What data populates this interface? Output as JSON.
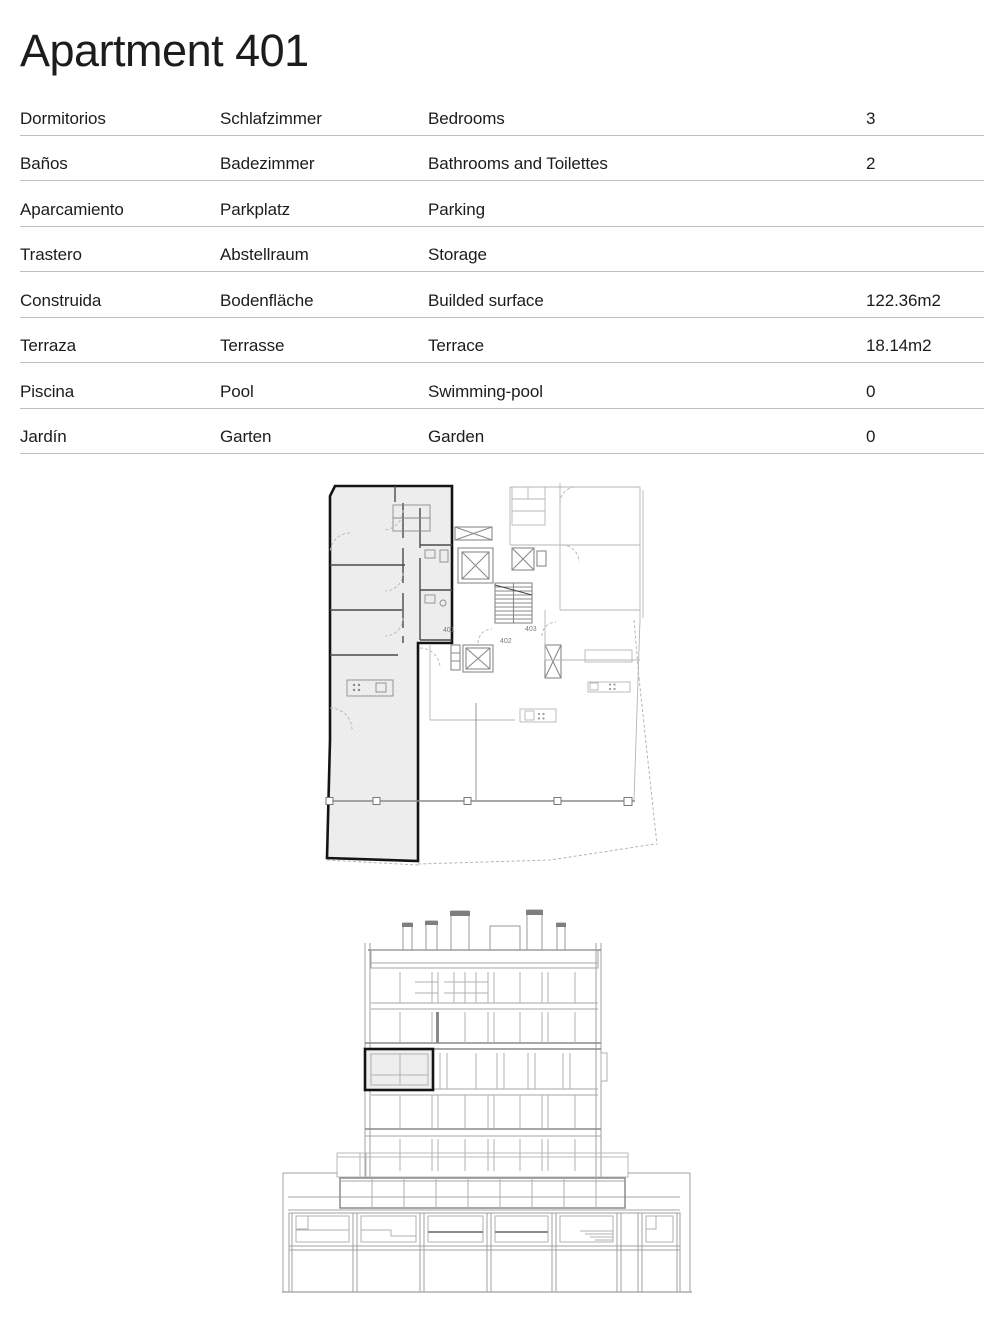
{
  "page": {
    "title": "Apartment 401"
  },
  "table": {
    "rows": [
      {
        "es": "Dormitorios",
        "de": "Schlafzimmer",
        "en": "Bedrooms",
        "value": "3"
      },
      {
        "es": "Baños",
        "de": "Badezimmer",
        "en": "Bathrooms and Toilettes",
        "value": "2"
      },
      {
        "es": "Aparcamiento",
        "de": "Parkplatz",
        "en": "Parking",
        "value": ""
      },
      {
        "es": "Trastero",
        "de": "Abstellraum",
        "en": "Storage",
        "value": ""
      },
      {
        "es": "Construida",
        "de": "Bodenfläche",
        "en": "Builded surface",
        "value": "122.36m2"
      },
      {
        "es": "Terraza",
        "de": "Terrasse",
        "en": "Terrace",
        "value": "18.14m2"
      },
      {
        "es": "Piscina",
        "de": "Pool",
        "en": "Swimming-pool",
        "value": "0"
      },
      {
        "es": "Jardín",
        "de": "Garten",
        "en": "Garden",
        "value": "0"
      }
    ]
  },
  "floorplan": {
    "unit_labels": {
      "a401": "401",
      "a402": "402",
      "a403": "403"
    }
  },
  "colors": {
    "ink": "#1c1c1c",
    "rule": "#bfbfbf",
    "draw-dark": "#4a4a4a",
    "draw-mid": "#8a8a8a",
    "draw-light": "#b5b5b5",
    "room-fill": "#efefef",
    "highlight": "#141414",
    "label": "#7a7a7a"
  }
}
